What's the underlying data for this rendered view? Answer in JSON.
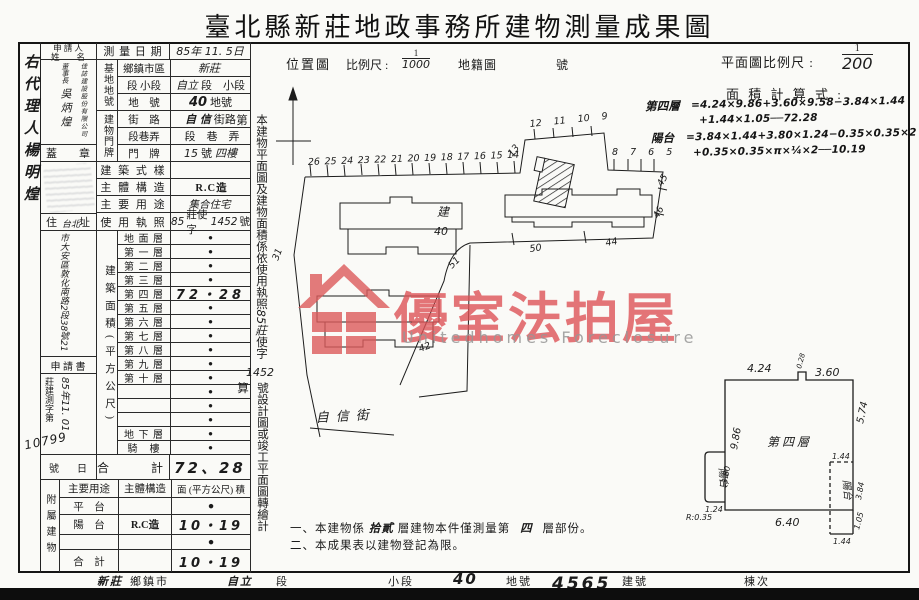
{
  "title": "臺北縣新莊地政事務所建物測量成果圖",
  "agent": "右代理人楊明煌",
  "applicant": {
    "header_l1": "申 請 人",
    "header_l2": "姓　　名",
    "company": "佳誌建設股份有限公司",
    "chairman_title": "董事長",
    "chairman_name": "吳炳煌",
    "seal_label": "蓋　　章",
    "addr_label": "住　　址",
    "addr_hand_prefix": "台北",
    "address": "市大安區敦化南路2段38號21",
    "form_label": "申 請 書",
    "file_prefix": "莊建測字第",
    "file_date": "85年11. 01",
    "file_no": "10799",
    "no_label": "號",
    "day_label": "日"
  },
  "survey": {
    "label": "測 量 日 期",
    "value": "85年 11. 5日"
  },
  "site_group": "基地地號",
  "door_group": "建物門牌",
  "rows_top": [
    {
      "label": "鄉鎮市區",
      "a": "新莊",
      "b": "",
      "c": ""
    },
    {
      "label": "段 小段",
      "a": "自立",
      "b": "段　小段",
      "c": ""
    },
    {
      "label": "地　號",
      "a": "40",
      "b": "地號",
      "c": ""
    },
    {
      "label": "街　路",
      "a": "自 信",
      "b": "街路",
      "c": ""
    },
    {
      "label": "段巷弄",
      "a": "",
      "b": "段　巷　弄",
      "c": ""
    },
    {
      "label": "門　牌",
      "a": "15",
      "b": "號",
      "c": "四樓"
    }
  ],
  "rows_mid": [
    {
      "label": "建 築 式 樣",
      "a": "",
      "b": "",
      "c": "",
      "d": ""
    },
    {
      "label": "主 體 構 造",
      "a": "",
      "b": "R.C造",
      "c": "",
      "d": ""
    },
    {
      "label": "主 要 用 途",
      "a": "集合住宅",
      "b": "",
      "c": "",
      "d": ""
    },
    {
      "label": "使 用 執 照",
      "a": "85",
      "b": "莊使字",
      "c": "1452",
      "d": "號"
    }
  ],
  "area_col": "建築面積(平方公尺)",
  "floors": [
    {
      "label": "地 面 層",
      "value": "●"
    },
    {
      "label": "第 一 層",
      "value": "●"
    },
    {
      "label": "第 二 層",
      "value": "●"
    },
    {
      "label": "第 三 層",
      "value": "●"
    },
    {
      "label": "第 四 層",
      "value": "72・28"
    },
    {
      "label": "第 五 層",
      "value": "●"
    },
    {
      "label": "第 六 層",
      "value": "●"
    },
    {
      "label": "第 七 層",
      "value": "●"
    },
    {
      "label": "第 八 層",
      "value": "●"
    },
    {
      "label": "第 九 層",
      "value": "●"
    },
    {
      "label": "第 十 層",
      "value": "●"
    },
    {
      "label": "",
      "value": "●"
    },
    {
      "label": "",
      "value": "●"
    },
    {
      "label": "",
      "value": "●"
    },
    {
      "label": "地 下 層",
      "value": "●"
    },
    {
      "label": "騎　樓",
      "value": "●"
    }
  ],
  "total": {
    "label": "合　　計",
    "value": "72、28"
  },
  "annex": {
    "col": "附屬建物",
    "h_use": "主要用途",
    "h_struct": "主體構造",
    "h_area": "面 (平方公尺) 積",
    "rows": [
      {
        "use": "平　台",
        "struct": "",
        "area": "●"
      },
      {
        "use": "陽　台",
        "struct": "R.C造",
        "area": "10・19"
      },
      {
        "use": "",
        "struct": "",
        "area": "●"
      },
      {
        "use": "合　計",
        "struct": "",
        "area": "10・19"
      }
    ]
  },
  "strip": {
    "part1": "本建物平面圖及建物面積係依使用執照",
    "hand1": "85莊",
    "part2": "使字第",
    "hand_no": "1452",
    "part3": "號設計圖或竣工平面圖轉繪計算"
  },
  "map_header": {
    "caption": "位置圖",
    "scale_label": "比例尺 :",
    "num": "1",
    "den": "1000",
    "type": "地籍圖",
    "no": "號"
  },
  "plan_header": {
    "scale_label": "平面圖比例尺 :",
    "num": "1",
    "den": "200",
    "calc": "面 積 計 算 式 :"
  },
  "calc": {
    "f4_label": "第四層",
    "f4_l1": "=4.24×9.86+3.60×9.58−3.84×1.44",
    "f4_l2": "+1.44×1.05──72.28",
    "bal_label": "陽台",
    "bal_l1": "=3.84×1.44+3.80×1.24−0.35×0.35×2",
    "bal_l2": "+0.35×0.35×π×¼×2──10.19"
  },
  "map": {
    "lots_top": "26 25 24 23 22 21 20 19 18 17 16 15 14",
    "lot_13": "13",
    "lots_ur": "12 11 10 9",
    "lots_rt": "8 7 6 5",
    "lot_45": "45",
    "lot_46": "46",
    "lot_44": "44",
    "lot_50": "50",
    "lot_51": "51",
    "lot_31": "31",
    "lot_42": "42",
    "subject_char": "建",
    "subject_no": "40",
    "street": "自信街"
  },
  "floorplan": {
    "label": "第四層",
    "d_top": "4.24",
    "d_notch": "0.28",
    "d_topr": "3.60",
    "d_right": "5.74",
    "d_left": "9.86",
    "d_bottom": "6.40",
    "balcony_left": "陽台",
    "balcony_right": "陽台",
    "lb_h": "3.80",
    "lb_w": "1.24",
    "radius_note": "R:0.35",
    "rb_top": "1.44",
    "rb_h": "3.84",
    "rb_low": "1.05",
    "rb_bot": "1.44"
  },
  "notes": {
    "n1a": "一、本建物係",
    "n1h": "拾貳",
    "n1b": "層建物本件僅測量第",
    "n1f": "四",
    "n1c": "層部份。",
    "n2": "二、本成果表以建物登記為限。"
  },
  "footer": {
    "town_hand": "新莊",
    "town": "鄉鎮市",
    "sec_hand": "自立",
    "sec": "段",
    "subsec": "小段",
    "lot_hand": "40",
    "lot": "地號",
    "bno_hand": "4565",
    "bno": "建號",
    "unit": "棟次"
  },
  "watermark": {
    "cn": "優室法拍屋",
    "en": "Unitedhomes Foreclosure"
  }
}
